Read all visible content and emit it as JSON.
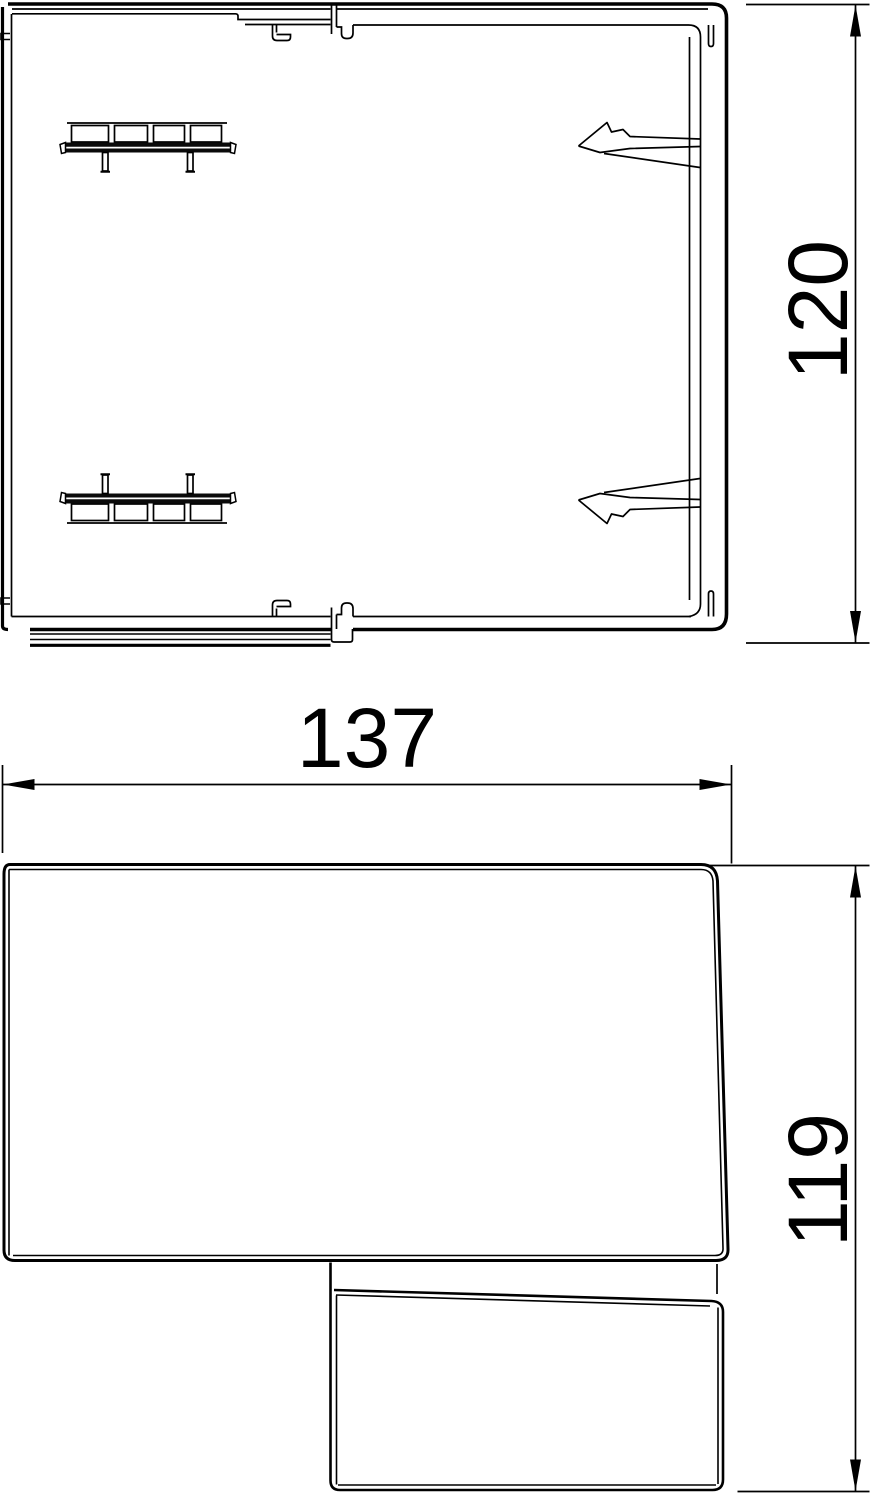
{
  "page": {
    "background_color": "#ffffff"
  },
  "drawing": {
    "kind": "technical-dimension-drawing",
    "line_color": "#000000",
    "views": [
      {
        "id": "profile-section-view",
        "position": "top"
      },
      {
        "id": "side-view",
        "position": "bottom"
      }
    ],
    "dimensions": [
      {
        "id": "dim-height-120",
        "label": "120",
        "orientation": "vertical",
        "view": "profile-section-view"
      },
      {
        "id": "dim-width-137",
        "label": "137",
        "orientation": "horizontal",
        "view": "side-view"
      },
      {
        "id": "dim-height-119",
        "label": "119",
        "orientation": "vertical",
        "view": "side-view"
      }
    ]
  }
}
